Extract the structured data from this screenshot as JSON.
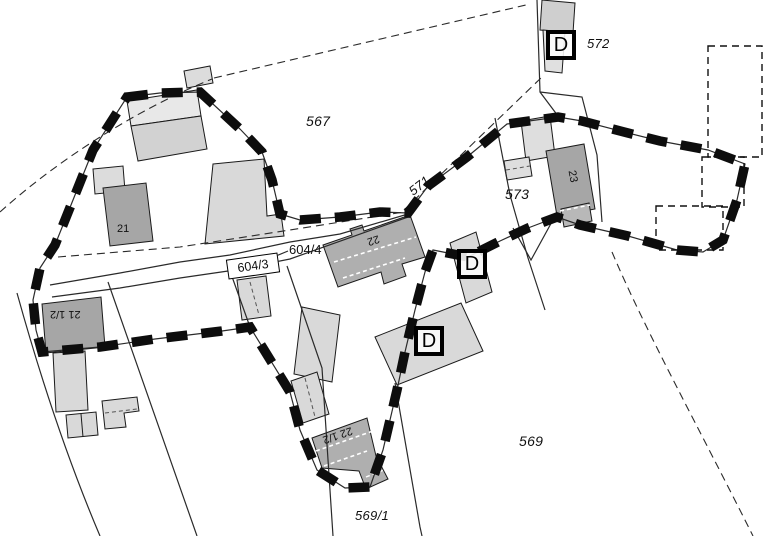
{
  "map": {
    "kind": "cadastral-parcel-map",
    "parcel_labels": [
      {
        "id": "567",
        "text": "567"
      },
      {
        "id": "571",
        "text": "571"
      },
      {
        "id": "572",
        "text": "572"
      },
      {
        "id": "573",
        "text": "573"
      },
      {
        "id": "569",
        "text": "569"
      },
      {
        "id": "569-1",
        "text": "569/1"
      }
    ],
    "road_labels": {
      "boxed": "604/3",
      "leader": "604/4"
    },
    "building_labels": [
      {
        "id": "21",
        "text": "21"
      },
      {
        "id": "21-half",
        "text": "21 1/2"
      },
      {
        "id": "22",
        "text": "22"
      },
      {
        "id": "22-half",
        "text": "22 1/2"
      },
      {
        "id": "23",
        "text": "23"
      }
    ],
    "markers": [
      {
        "id": "d-top",
        "label": "D"
      },
      {
        "id": "d-middle",
        "label": "D"
      },
      {
        "id": "d-lower",
        "label": "D"
      }
    ],
    "colors": {
      "background": "#ffffff",
      "building_light": "#d9d9d9",
      "building_lighter": "#e6e6e6",
      "building_medium": "#b0b0b0",
      "building_dark": "#a6a6a6",
      "boundary_thick": "#0d0d0d",
      "line_thin": "#2a2a2a"
    }
  }
}
